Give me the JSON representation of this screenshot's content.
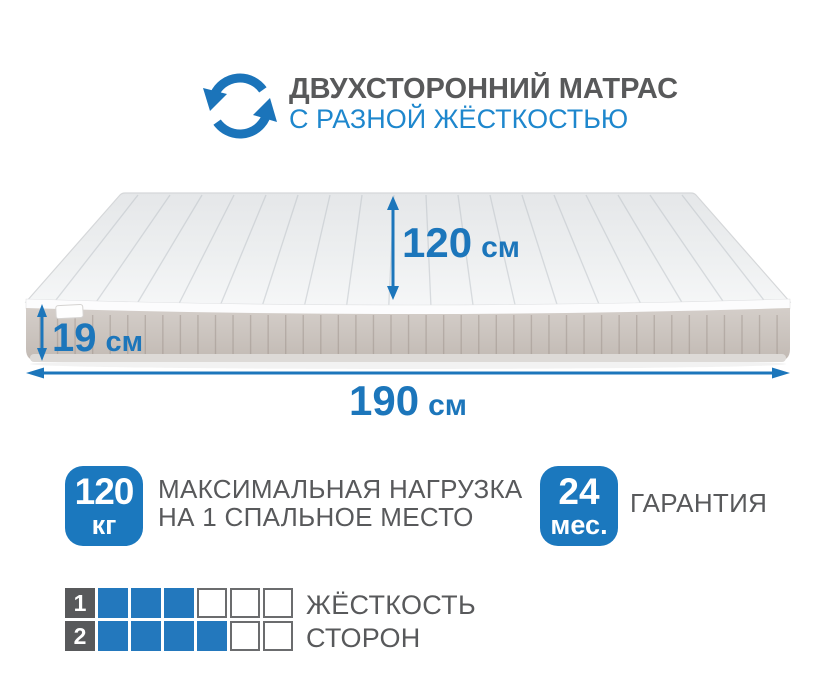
{
  "header": {
    "title": "ДВУХСТОРОННИЙ МАТРАС",
    "subtitle": "С РАЗНОЙ ЖЁСТКОСТЬЮ",
    "icon": "rotate-icon"
  },
  "mattress": {
    "width": {
      "value": "120",
      "unit": "см"
    },
    "height": {
      "value": "19",
      "unit": "см"
    },
    "length": {
      "value": "190",
      "unit": "см"
    }
  },
  "features": {
    "max_load": {
      "badge_value": "120",
      "badge_unit": "кг",
      "label_line1": "МАКСИМАЛЬНАЯ НАГРУЗКА",
      "label_line2": "НА 1 СПАЛЬНОЕ МЕСТО"
    },
    "warranty": {
      "badge_value": "24",
      "badge_unit": "мес.",
      "label": "ГАРАНТИЯ"
    }
  },
  "firmness": {
    "label_line1": "ЖЁСТКОСТЬ",
    "label_line2": "СТОРОН",
    "rows": [
      {
        "side": "1",
        "filled": 3,
        "total": 6
      },
      {
        "side": "2",
        "filled": 4,
        "total": 6
      }
    ]
  },
  "colors": {
    "accent_blue": "#1c76bb",
    "subtitle_blue": "#1e87cd",
    "badge_blue": "#1b78be",
    "square_blue": "#2378bd",
    "text_gray": "#58595b",
    "mattress_top": "#eceef0",
    "mattress_side": "#cac3bd"
  }
}
